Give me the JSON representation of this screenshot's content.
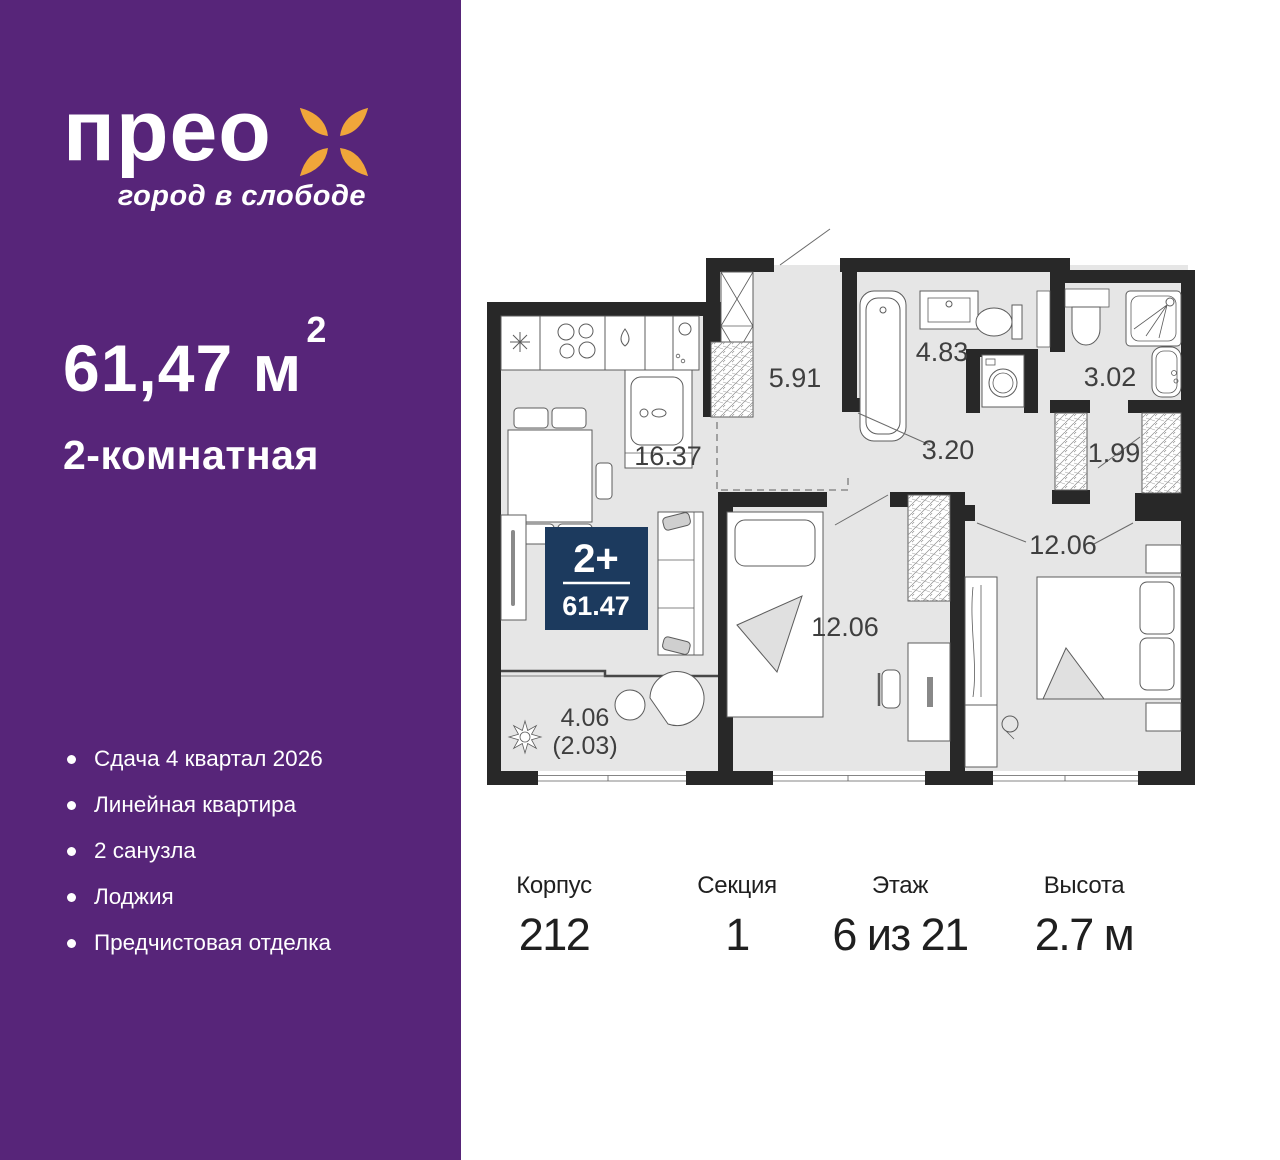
{
  "sidebar": {
    "bg_color": "#572579",
    "logo": {
      "brand": "прео",
      "tagline": "город в слободе",
      "flower_color": "#F0A63A"
    },
    "area_value": "61,47 м",
    "area_sup": "2",
    "apartment_type": "2-комнатная",
    "features": [
      {
        "label": "Сдача 4 квартал 2026"
      },
      {
        "label": "Линейная квартира"
      },
      {
        "label": "2 санузла"
      },
      {
        "label": "Лоджия"
      },
      {
        "label": "Предчистовая отделка"
      }
    ]
  },
  "plan": {
    "badge": {
      "rooms": "2+",
      "area": "61.47",
      "bg_color": "#1C3A5E"
    },
    "labels": {
      "kitchen_living": "16.37",
      "hall": "5.91",
      "bathroom": "4.83",
      "corridor": "3.20",
      "shower_room": "3.02",
      "wardrobe": "1.99",
      "bedroom_1": "12.06",
      "bedroom_2": "12.06",
      "loggia_full": "4.06",
      "loggia_reduced": "(2.03)"
    },
    "colors": {
      "wall": "#282828",
      "floor": "#e6e6e6"
    }
  },
  "info": {
    "columns": [
      {
        "label": "Корпус",
        "value": "212"
      },
      {
        "label": "Секция",
        "value": "1"
      },
      {
        "label": "Этаж",
        "value": "6 из 21"
      },
      {
        "label": "Высота",
        "value": "2.7 м"
      }
    ]
  }
}
